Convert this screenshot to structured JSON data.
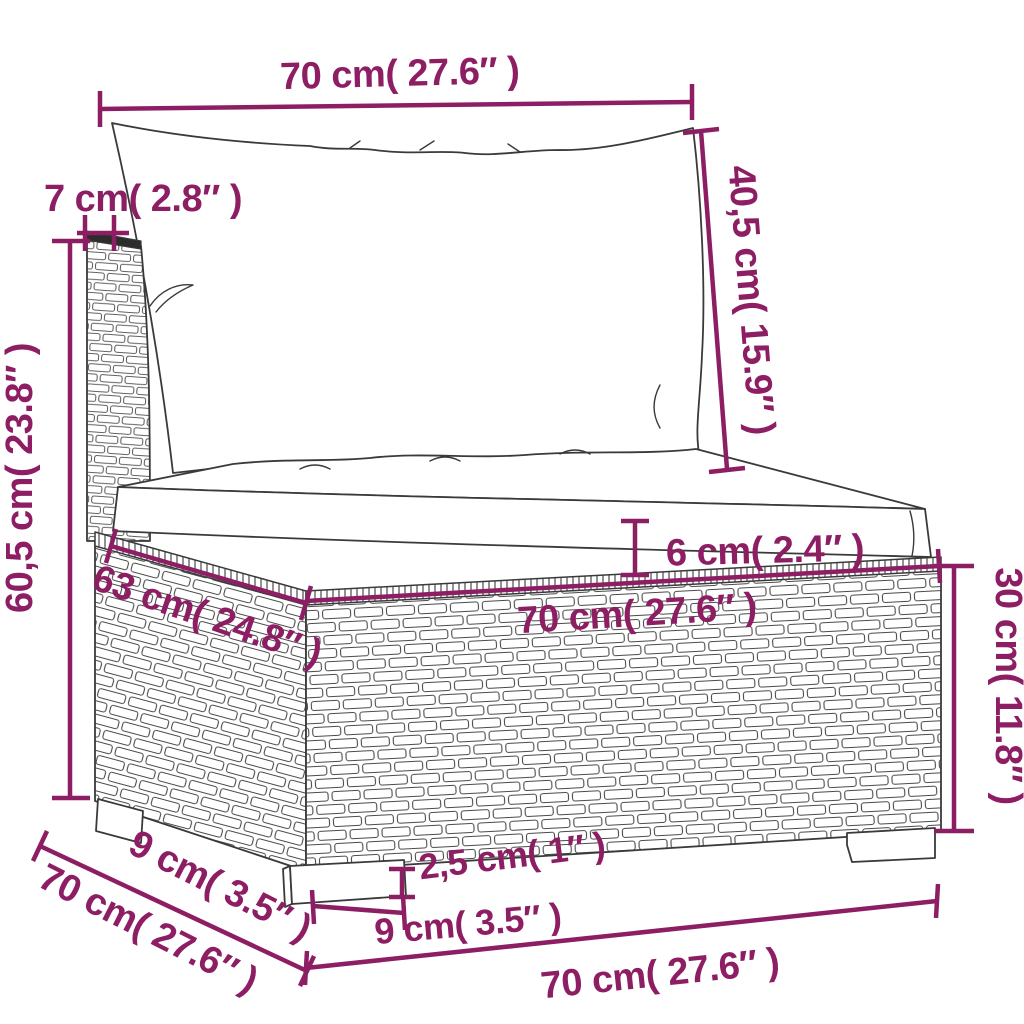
{
  "diagram": {
    "type": "furniture-dimension-diagram",
    "subject": "poly rattan garden sofa middle section with back cushion and seat cushion",
    "accent_color": "#8d1e64",
    "outline_color": "#3a3a3a",
    "units": [
      "cm",
      "inch"
    ],
    "labels": {
      "cushion_width_top": "70 cm( 27.6″ )",
      "back_thickness": "7 cm( 2.8″ )",
      "back_cushion_height": "40,5 cm( 15.9″ )",
      "overall_height": "60,5 cm( 23.8″ )",
      "seat_depth": "63 cm( 24.8″ )",
      "seat_cushion_thickness": "6 cm( 2.4″ )",
      "seat_width": "70 cm( 27.6″ )",
      "base_height": "30 cm( 11.8″ )",
      "leg_height": "2,5 cm( 1″ )",
      "leg_width": "9 cm( 3.5″ )",
      "side_leg_width": "9 cm( 3.5″ )",
      "overall_depth": "70 cm( 27.6″ )",
      "overall_width": "70 cm( 27.6″ )"
    }
  }
}
